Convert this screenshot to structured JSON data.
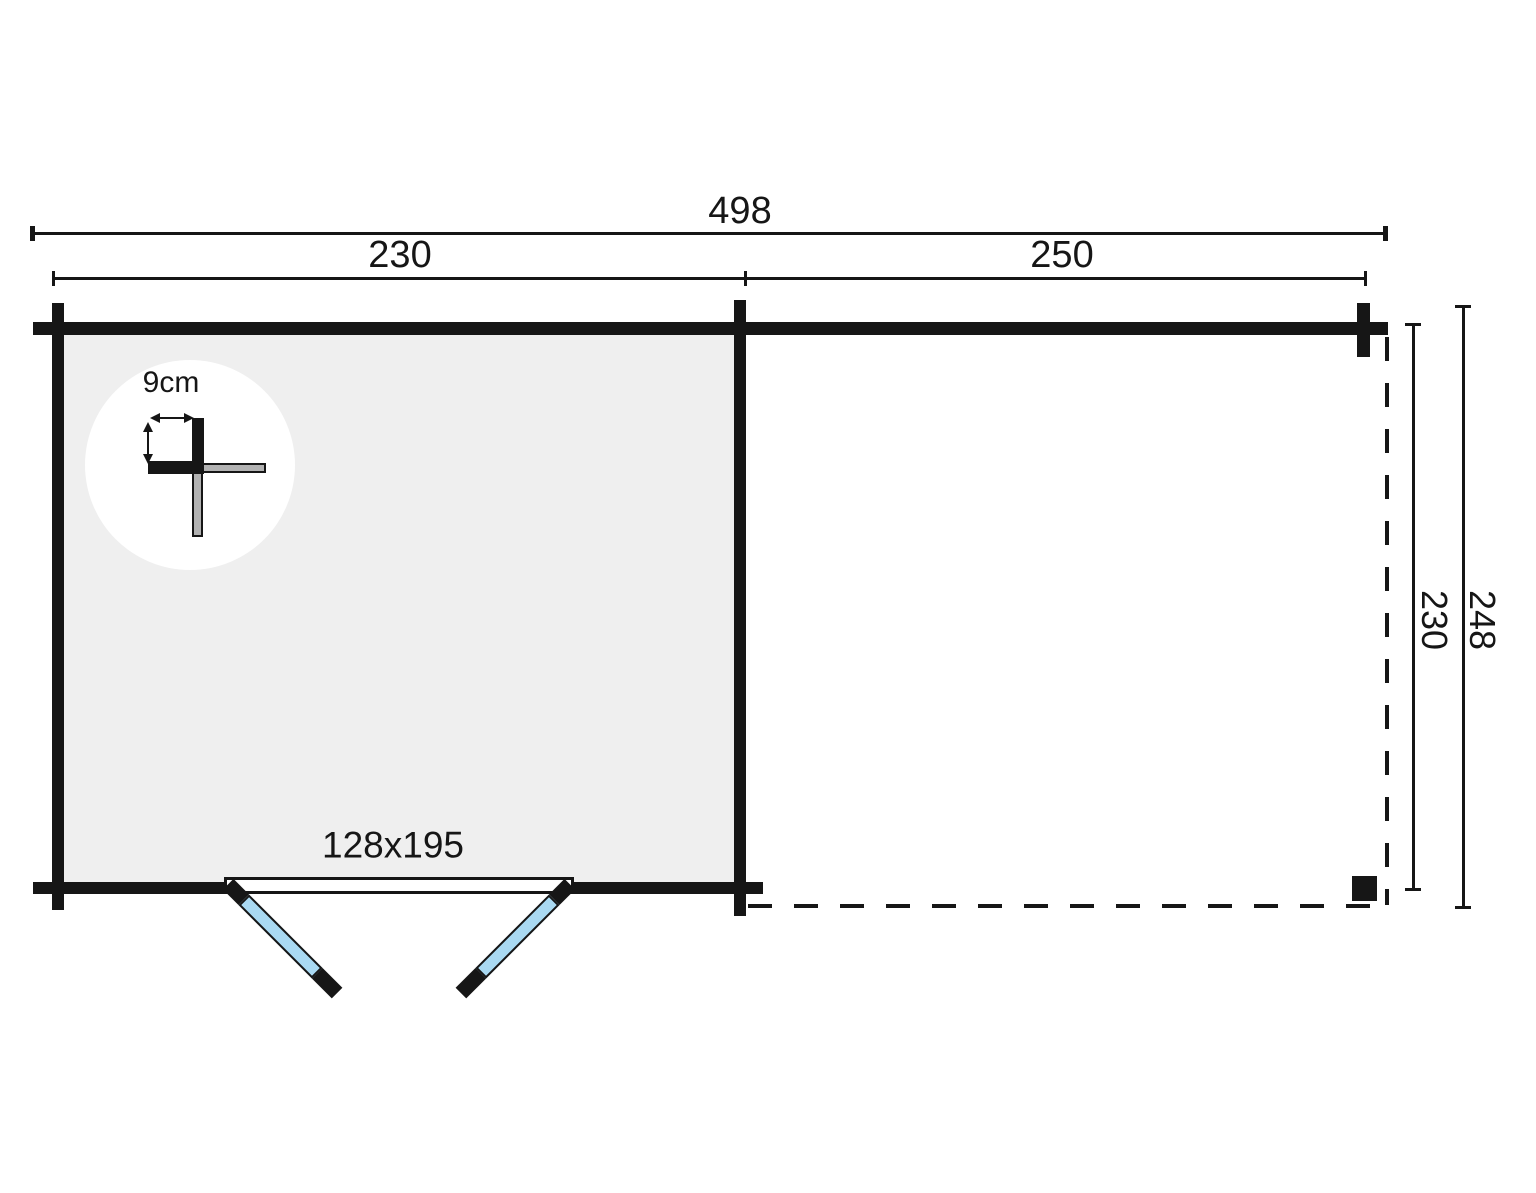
{
  "diagram": {
    "type": "floor-plan",
    "unit": "cm",
    "labels": {
      "total_width": "498",
      "cabin_width": "230",
      "canopy_width": "250",
      "canopy_depth": "230",
      "total_depth": "248",
      "wall_thickness": "9cm",
      "door_size": "128x195"
    },
    "colors": {
      "line": "#161616",
      "room_fill": "#efefef",
      "door_glass": "#a9d9f2",
      "detail_gray": "#b2b2b2",
      "background": "#ffffff"
    }
  }
}
